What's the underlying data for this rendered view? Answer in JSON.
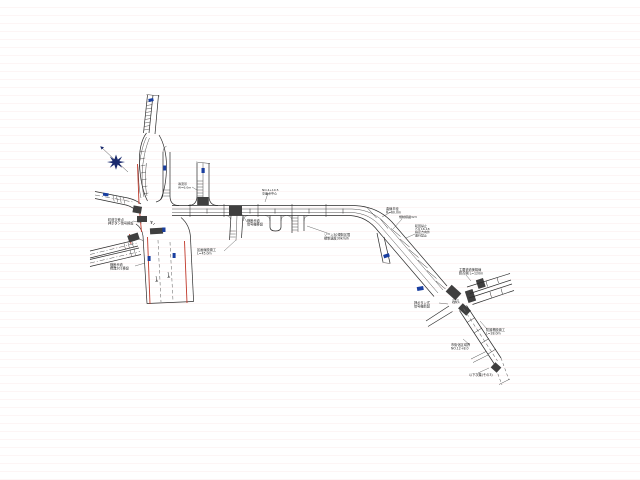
{
  "drawing": {
    "type": "road-improvement-plan",
    "background_color": "#ffffff",
    "colors": {
      "line": "#2b2b2b",
      "edge_marking_red": "#c0392b",
      "sign_marker_blue": "#1a3fa0",
      "crosswalk_block": "#3f3f3f",
      "north_arrow": "#1a2a6e"
    },
    "north_arrow": {
      "x": 116,
      "y": 162,
      "ray_tip_x": 101,
      "ray_tip_y": 147
    },
    "sign_markers": [
      {
        "x": 148.5,
        "y": 98.5,
        "w": 5,
        "h": 3,
        "rot": -12
      },
      {
        "x": 163.2,
        "y": 165.5,
        "w": 3,
        "h": 5,
        "rot": 0
      },
      {
        "x": 201.5,
        "y": 168,
        "w": 3.2,
        "h": 5,
        "rot": 0
      },
      {
        "x": 103,
        "y": 193,
        "w": 5.5,
        "h": 3,
        "rot": 8
      },
      {
        "x": 147.6,
        "y": 256,
        "w": 3,
        "h": 5,
        "rot": 0
      },
      {
        "x": 172.6,
        "y": 253,
        "w": 3,
        "h": 5,
        "rot": 0
      },
      {
        "x": 162.3,
        "y": 227.5,
        "w": 3.2,
        "h": 4.5,
        "rot": 0
      },
      {
        "x": 383.5,
        "y": 254,
        "w": 6,
        "h": 3.5,
        "rot": -18
      },
      {
        "x": 417,
        "y": 286.5,
        "w": 6.5,
        "h": 4,
        "rot": -10
      }
    ],
    "annotations": [
      {
        "x": 108,
        "y": 221,
        "fs": 3.2,
        "lines": [
          "町道交差点",
          "押ボタン信号移設"
        ],
        "leader": [
          133,
          221,
          142,
          223
        ]
      },
      {
        "x": 110,
        "y": 266,
        "fs": 3.2,
        "lines": [
          "横断歩道",
          "標識201移設"
        ],
        "leader": [
          135,
          266,
          145,
          263
        ]
      },
      {
        "x": 178,
        "y": 185,
        "fs": 3.0,
        "lines": [
          "導流帯",
          "W=6.0m"
        ],
        "leader": [
          192,
          187,
          197,
          190
        ]
      },
      {
        "x": 247,
        "y": 222,
        "fs": 3.2,
        "lines": [
          "横断歩道",
          "信号機移設"
        ],
        "leader": [
          247,
          222,
          241,
          213
        ]
      },
      {
        "x": 197,
        "y": 251,
        "fs": 3.2,
        "lines": [
          "区画線設置工",
          "L=45.0m"
        ],
        "leader": [
          224,
          251,
          236,
          240
        ]
      },
      {
        "x": 324,
        "y": 236,
        "fs": 3.2,
        "lines": [
          "ゾーン30規制区間",
          "規制速度30km/h"
        ],
        "leader": [
          330,
          234,
          307,
          226
        ]
      },
      {
        "x": 262,
        "y": 191,
        "fs": 3.0,
        "lines": [
          "NO.4+10.5",
          "交差点中心"
        ],
        "leader": [
          268,
          193,
          265,
          202
        ]
      },
      {
        "x": 386,
        "y": 210,
        "fs": 3.2,
        "lines": [
          "曲線半径",
          "R=60.0m"
        ],
        "leader": [
          391,
          212,
          382,
          217
        ]
      },
      {
        "x": 399,
        "y": 218,
        "fs": 3.0,
        "lines": [
          "規制標識323"
        ],
        "leader": [
          402,
          219,
          393,
          229
        ]
      },
      {
        "x": 415,
        "y": 227,
        "fs": 3.0,
        "lh": 3.1,
        "lines": [
          "転回禁止",
          "7-9 16-18",
          "指定方向外",
          "進行禁止"
        ],
        "leader": [
          415,
          234,
          406,
          238
        ]
      },
      {
        "x": 459,
        "y": 271,
        "fs": 3.2,
        "lines": [
          "主要道道美幌線",
          "終点側 L=120m"
        ],
        "leader": [
          466,
          275,
          471,
          281
        ]
      },
      {
        "x": 414,
        "y": 304,
        "fs": 3.2,
        "lines": [
          "押ボタン式",
          "信号機新設"
        ],
        "leader": [
          439,
          303,
          448,
          304
        ]
      },
      {
        "x": 486,
        "y": 331,
        "fs": 3.2,
        "lines": [
          "防護柵設置工",
          "L=28.0m"
        ],
        "leader": [
          487,
          329,
          480,
          321
        ]
      },
      {
        "x": 451,
        "y": 346,
        "fs": 3.2,
        "lines": [
          "市街化区域界",
          "NO.12+8.0"
        ],
        "leader": [
          470,
          345,
          463,
          339
        ]
      },
      {
        "x": 469,
        "y": 376,
        "fs": 3.2,
        "lines": [
          "以下次葉(その3)"
        ],
        "leader": [
          478,
          373,
          489,
          368
        ]
      },
      {
        "x": 452,
        "y": 301,
        "fs": 2.4,
        "lh": 2.6,
        "lines": [
          "交会点",
          "KBM.4"
        ]
      }
    ]
  }
}
